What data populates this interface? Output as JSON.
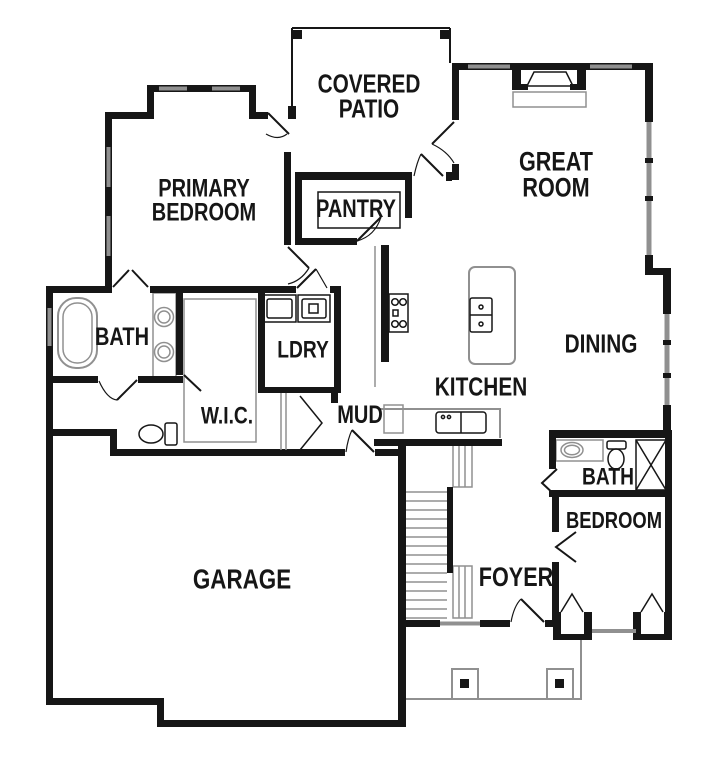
{
  "plan": {
    "type": "residential-floor-plan",
    "colors": {
      "wall": "#161616",
      "window_line": "#909090",
      "background": "#ffffff"
    },
    "rooms": {
      "covered_patio": {
        "label": "COVERED\nPATIO"
      },
      "great_room": {
        "label": "GREAT\nROOM"
      },
      "primary_bedroom": {
        "label": "PRIMARY\nBEDROOM"
      },
      "pantry": {
        "label": "PANTRY"
      },
      "primary_bath": {
        "label": "BATH"
      },
      "laundry": {
        "label": "LDRY"
      },
      "dining": {
        "label": "DINING"
      },
      "kitchen": {
        "label": "KITCHEN"
      },
      "walk_in_closet": {
        "label": "W.I.C."
      },
      "mud_room": {
        "label": "MUD"
      },
      "hall_bath": {
        "label": "BATH"
      },
      "bedroom_2": {
        "label": "BEDROOM"
      },
      "garage": {
        "label": "GARAGE"
      },
      "foyer": {
        "label": "FOYER"
      }
    },
    "fixtures": [
      "fireplace",
      "bathtub",
      "double-vanity-sinks",
      "toilet",
      "washer",
      "dryer",
      "range-cooktop",
      "island-sink",
      "kitchen-sink",
      "stairs",
      "shower",
      "vanity-sink",
      "bifold-closet",
      "window-bay",
      "porch-post",
      "patio-post"
    ]
  }
}
